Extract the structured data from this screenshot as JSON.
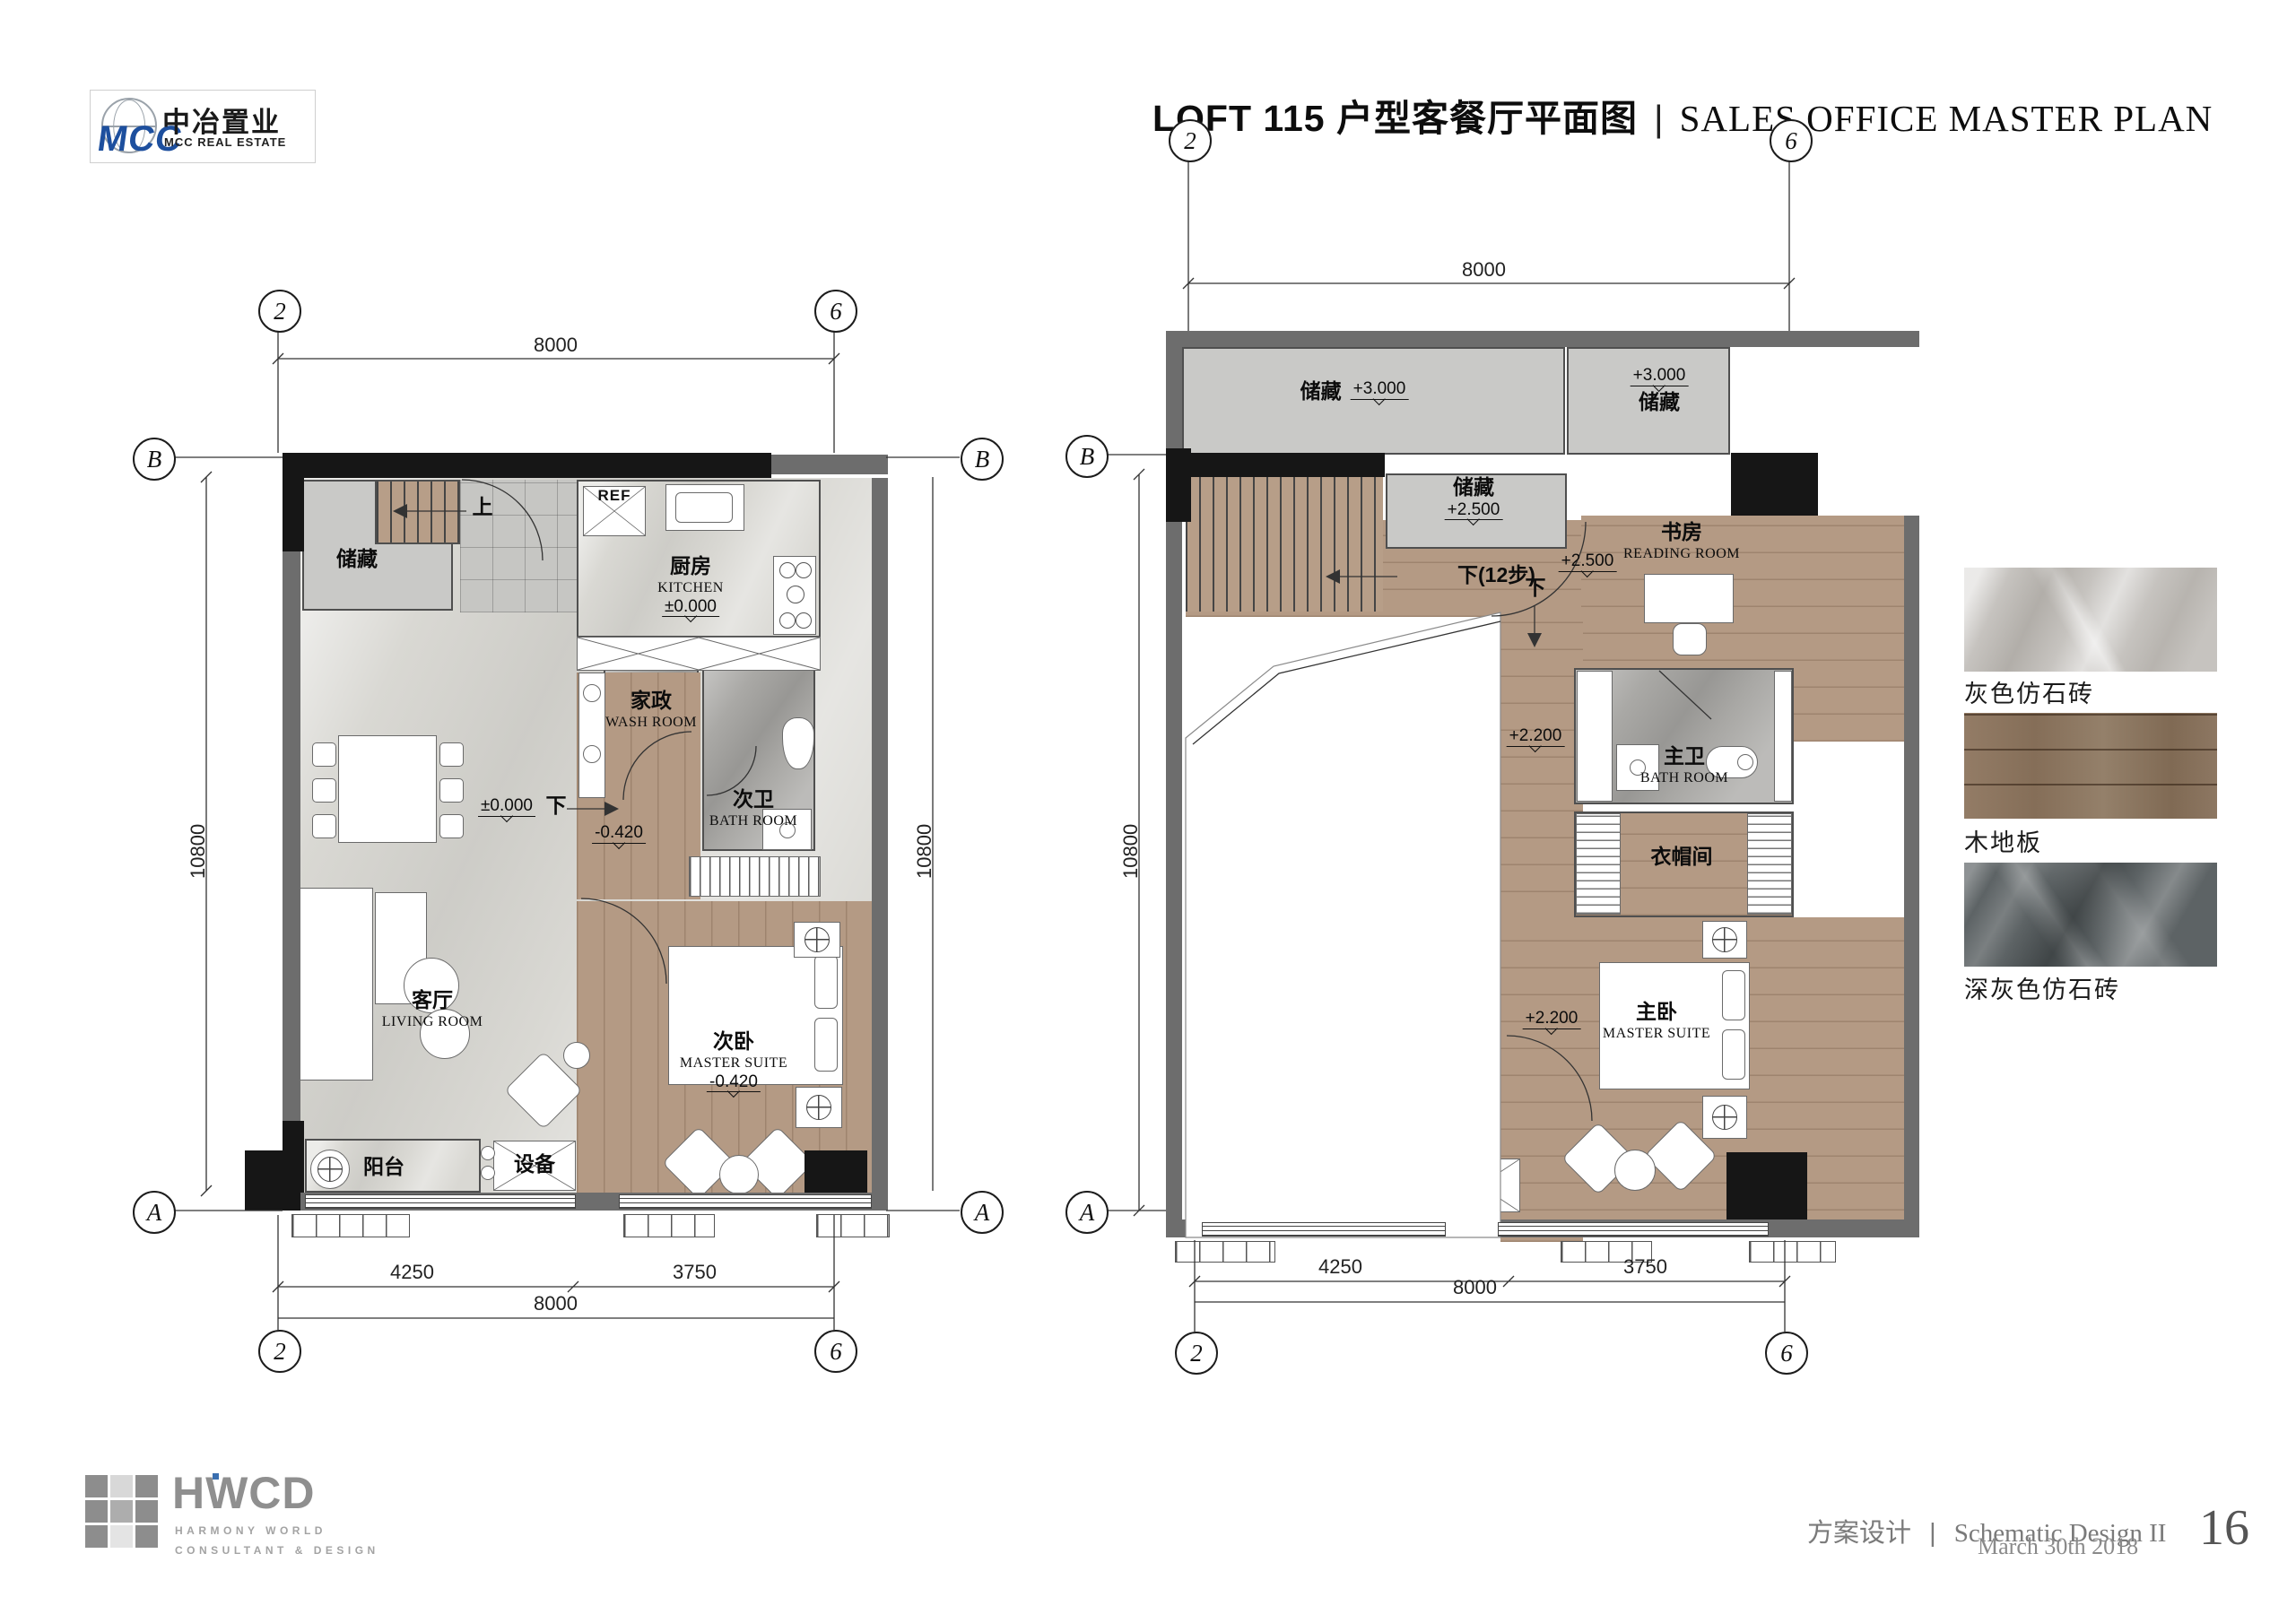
{
  "header": {
    "logo": {
      "mcc": "MCC",
      "cn": "中冶置业",
      "en": "MCC REAL ESTATE"
    },
    "title": {
      "cn": "LOFT 115 户型客餐厅平面图",
      "sep": "|",
      "en": "SALES OFFICE MASTER PLAN"
    }
  },
  "plan_left": {
    "grid": {
      "g2": "2",
      "g6": "6",
      "gB": "B",
      "gA": "A"
    },
    "dims": {
      "top": "8000",
      "left": "10800",
      "right": "10800",
      "d1": "4250",
      "d2": "3750",
      "total": "8000"
    },
    "labels": {
      "storage": "储藏",
      "up": "上",
      "ref": "REF",
      "kitchen_cn": "厨房",
      "kitchen_en": "KITCHEN",
      "kitchen_lvl": "±0.000",
      "wash_cn": "家政",
      "wash_en": "WASH ROOM",
      "bath_cn": "次卫",
      "bath_en": "BATH ROOM",
      "down": "下",
      "hall_lvl": "-0.420",
      "living_cn": "客厅",
      "living_en": "LIVING ROOM",
      "living_lvl": "±0.000",
      "suite_cn": "次卧",
      "suite_en": "MASTER SUITE",
      "suite_lvl": "-0.420",
      "balcony": "阳台",
      "equip": "设备"
    }
  },
  "plan_right": {
    "grid": {
      "g2": "2",
      "g6": "6",
      "gB": "B",
      "gA": "A"
    },
    "dims": {
      "top": "8000",
      "left": "10800",
      "d1": "4250",
      "d2": "3750",
      "total": "8000"
    },
    "labels": {
      "storage1": "储藏",
      "storage1_lvl": "+3.000",
      "storage2": "储藏",
      "storage2_lvl": "+3.000",
      "storage3": "储藏",
      "storage3_lvl": "+2.500",
      "stair_note": "下(12步)",
      "reading_cn": "书房",
      "reading_en": "READING ROOM",
      "reading_lvl": "+2.500",
      "down": "下",
      "corridor_lvl": "+2.200",
      "bath_cn": "主卫",
      "bath_en": "BATH ROOM",
      "cloak": "衣帽间",
      "suite_cn": "主卧",
      "suite_en": "MASTER SUITE",
      "suite_lvl": "+2.200"
    }
  },
  "materials": [
    {
      "label": "灰色仿石砖"
    },
    {
      "label": "木地板"
    },
    {
      "label": "深灰色仿石砖"
    }
  ],
  "footer": {
    "hwcd": {
      "name": "HWCD",
      "line1": "HARMONY WORLD",
      "line2": "CONSULTANT & DESIGN"
    },
    "phase_cn": "方案设计",
    "sep": "|",
    "phase_en": "Schematic Design II",
    "date": "March 30th 2018",
    "page": "16"
  }
}
